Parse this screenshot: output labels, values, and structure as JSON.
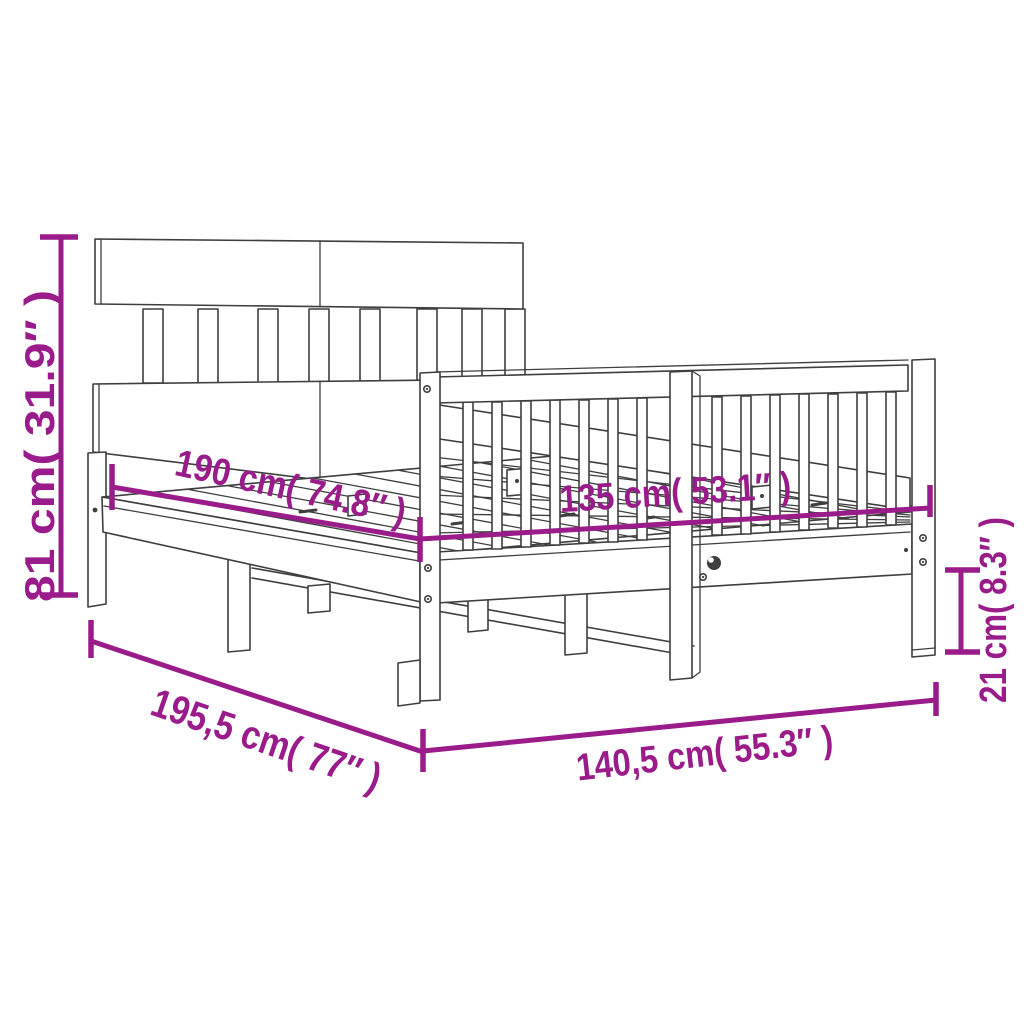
{
  "diagram": {
    "subject": "line drawing of a wooden bed frame with slatted headboard, spindle footboard and slatted base, shown in perspective",
    "colors": {
      "background": "#ffffff",
      "line_art": "#3e3e3e",
      "dimension": "#9a1c8a"
    },
    "dimensions": [
      {
        "id": "headboard-height",
        "label": "81 cm( 31.9″ )",
        "value_cm": "81",
        "value_in": "31.9"
      },
      {
        "id": "inner-length",
        "label": "190 cm( 74.8″ )",
        "value_cm": "190",
        "value_in": "74.8"
      },
      {
        "id": "inner-width",
        "label": "135 cm( 53.1″ )",
        "value_cm": "135",
        "value_in": "53.1"
      },
      {
        "id": "under-frame-height",
        "label": "21 cm( 8.3″ )",
        "value_cm": "21",
        "value_in": "8.3"
      },
      {
        "id": "outer-length",
        "label": "195,5 cm( 77″ )",
        "value_cm": "195,5",
        "value_in": "77"
      },
      {
        "id": "outer-width",
        "label": "140,5 cm( 55.3″ )",
        "value_cm": "140,5",
        "value_in": "55.3"
      }
    ]
  }
}
